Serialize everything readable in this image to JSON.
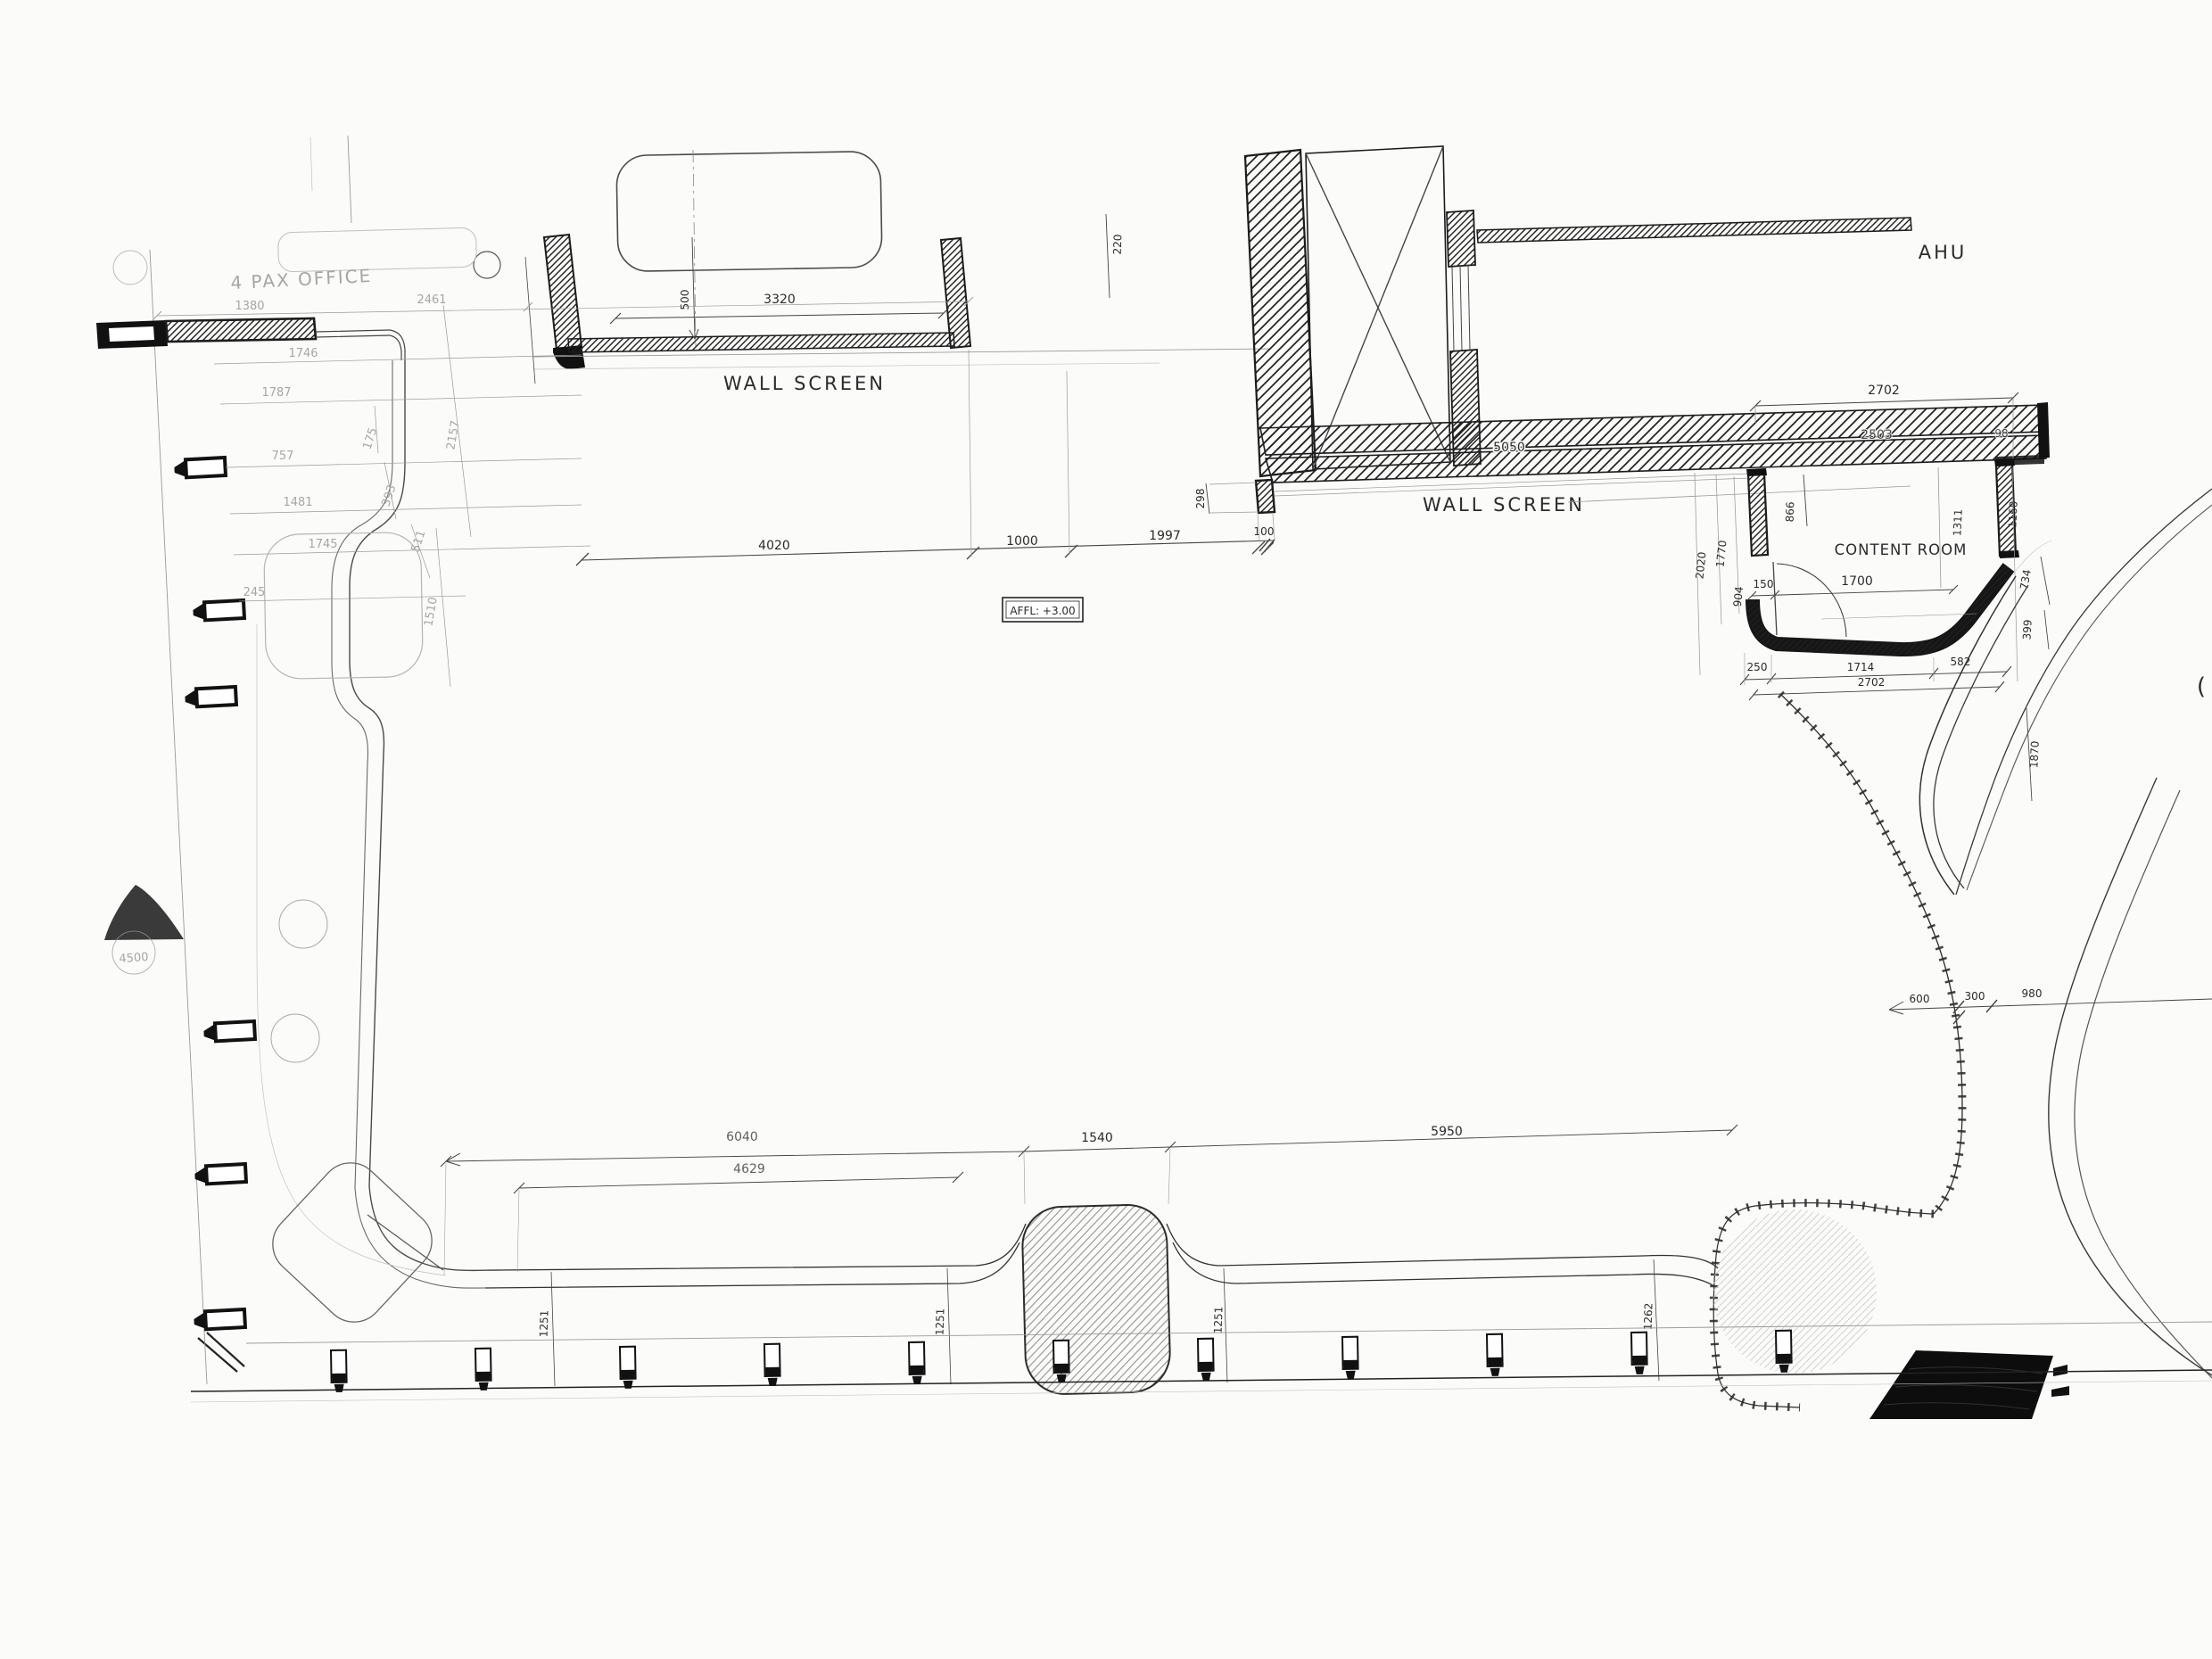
{
  "drawing": {
    "kind": "scanned architectural floor plan detail",
    "labels": {
      "pax_office": "4 PAX OFFICE",
      "wall_screen_a": "WALL SCREEN",
      "wall_screen_b": "WALL SCREEN",
      "ahu": "AHU",
      "content_room": "CONTENT ROOM",
      "affl": "AFFL: +3.00",
      "paren": "("
    },
    "dims": {
      "d3320": "3320",
      "d500": "500",
      "d4020": "4020",
      "d1000": "1000",
      "d1997": "1997",
      "d100": "100",
      "d220": "220",
      "d298": "298",
      "d2702a": "2702",
      "d5050": "5050",
      "d2503": "2503",
      "d98": "98",
      "d2020": "2020",
      "d1770": "1770",
      "d904": "904",
      "d866": "866",
      "d150": "150",
      "d1700": "1700",
      "d1311": "1311",
      "d1160": "1160",
      "d250": "250",
      "d1714": "1714",
      "d582": "582",
      "d2702b": "2702",
      "d734": "734",
      "d399": "399",
      "d1870": "1870",
      "d600": "600",
      "d300": "300",
      "d980": "980",
      "d6040": "6040",
      "d4629": "4629",
      "d1540": "1540",
      "d5950": "5950",
      "d1251a": "1251",
      "d1251b": "1251",
      "d1251c": "1251",
      "d1262": "1262",
      "f1380": "1380",
      "f2461": "2461",
      "f1746": "1746",
      "f1787": "1787",
      "f757": "757",
      "f1481": "1481",
      "f1745": "1745",
      "f245": "245",
      "f4500": "4500",
      "f175": "175",
      "f393": "393",
      "f511": "511",
      "f2157": "2157",
      "f1510": "1510"
    },
    "colors": {
      "paper": "#fbfbfa",
      "ink": "#2b2b2b",
      "pencil": "#a6a6a6"
    }
  }
}
